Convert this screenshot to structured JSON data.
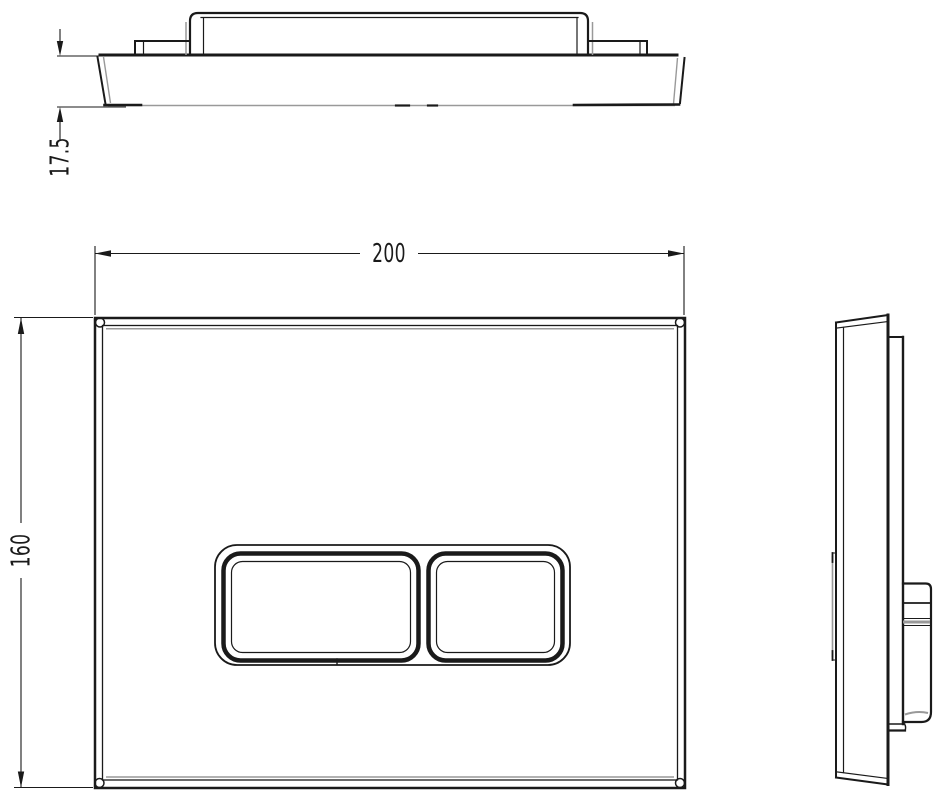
{
  "drawing": {
    "dimensions": {
      "plate_width": "200",
      "plate_height": "160",
      "plate_thickness": "17.5"
    },
    "colors": {
      "line": "#1a1a1a",
      "ghost_line": "#999999",
      "background": "#ffffff"
    }
  }
}
